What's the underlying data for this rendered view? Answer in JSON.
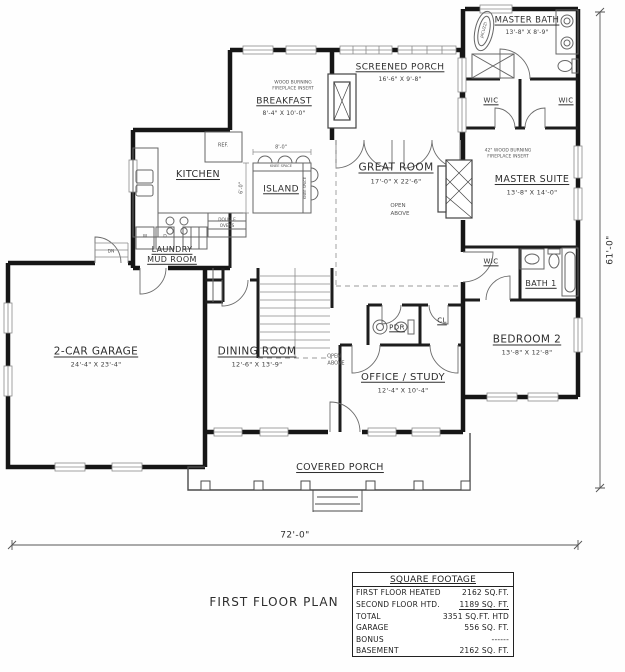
{
  "title": "FIRST FLOOR PLAN",
  "overall_dims": {
    "width": "72'-0\"",
    "height": "61'-0\""
  },
  "rooms": {
    "master_bath": {
      "name": "MASTER BATH",
      "dim": "13'-8\" X 8'-9\""
    },
    "wic_left": {
      "name": "WIC"
    },
    "wic_right": {
      "name": "WIC"
    },
    "master_suite": {
      "name": "MASTER SUITE",
      "dim": "13'-8\" X 14'-0\"",
      "note_line1": "42\" WOOD BURNING",
      "note_line2": "FIREPLACE INSERT"
    },
    "screened_porch": {
      "name": "SCREENED PORCH",
      "dim": "16'-6\" X 9'-8\""
    },
    "breakfast": {
      "name": "BREAKFAST",
      "dim": "8'-4\" X 10'-0\"",
      "note_line1": "WOOD BURNING",
      "note_line2": "FIREPLACE INSERT"
    },
    "great_room": {
      "name": "GREAT ROOM",
      "dim": "17'-0\" X 22'-6\"",
      "open_line1": "OPEN",
      "open_line2": "ABOVE"
    },
    "kitchen": {
      "name": "KITCHEN"
    },
    "island": {
      "name": "ISLAND",
      "dim_top": "8'-0\"",
      "dim_side": "6'-0\"",
      "edge_note": "KNEE SPACE"
    },
    "ref": {
      "name": "REF."
    },
    "double_ovens": {
      "line1": "DOUBLE",
      "line2": "OVENS"
    },
    "laundry": {
      "line1": "LAUNDRY",
      "line2": "MUD ROOM"
    },
    "garage": {
      "name": "2-CAR GARAGE",
      "dim": "24'-4\" X 23'-4\""
    },
    "dining": {
      "name": "DINING ROOM",
      "dim": "12'-6\" X 13'-9\""
    },
    "stairs": {
      "dn": "DN",
      "open_line1": "OPEN",
      "open_line2": "ABOVE"
    },
    "pdr": {
      "name": "PDR"
    },
    "closet": {
      "name": "CL"
    },
    "office": {
      "name": "OFFICE / STUDY",
      "dim": "12'-4\" X 10'-4\""
    },
    "wic_hall": {
      "name": "WIC"
    },
    "bath1": {
      "name": "BATH 1"
    },
    "bedroom2": {
      "name": "BEDROOM 2",
      "dim": "13'-8\" X 12'-8\""
    },
    "covered_porch": {
      "name": "COVERED PORCH"
    },
    "fixtures": {
      "jacuzzi": "JACUZZI",
      "washer": "W",
      "dryer": "D"
    }
  },
  "square_footage": {
    "header": "SQUARE FOOTAGE",
    "rows": [
      {
        "label": "FIRST FLOOR HEATED",
        "value": "2162 SQ.FT."
      },
      {
        "label": "SECOND FLOOR HTD.",
        "value": "1189 SQ. FT."
      },
      {
        "label": "TOTAL",
        "value": "3351 SQ.FT. HTD"
      },
      {
        "label": "GARAGE",
        "value": "556 SQ. FT."
      },
      {
        "label": "BONUS",
        "value": "------"
      },
      {
        "label": "BASEMENT",
        "value": "2162 SQ. FT."
      }
    ]
  }
}
